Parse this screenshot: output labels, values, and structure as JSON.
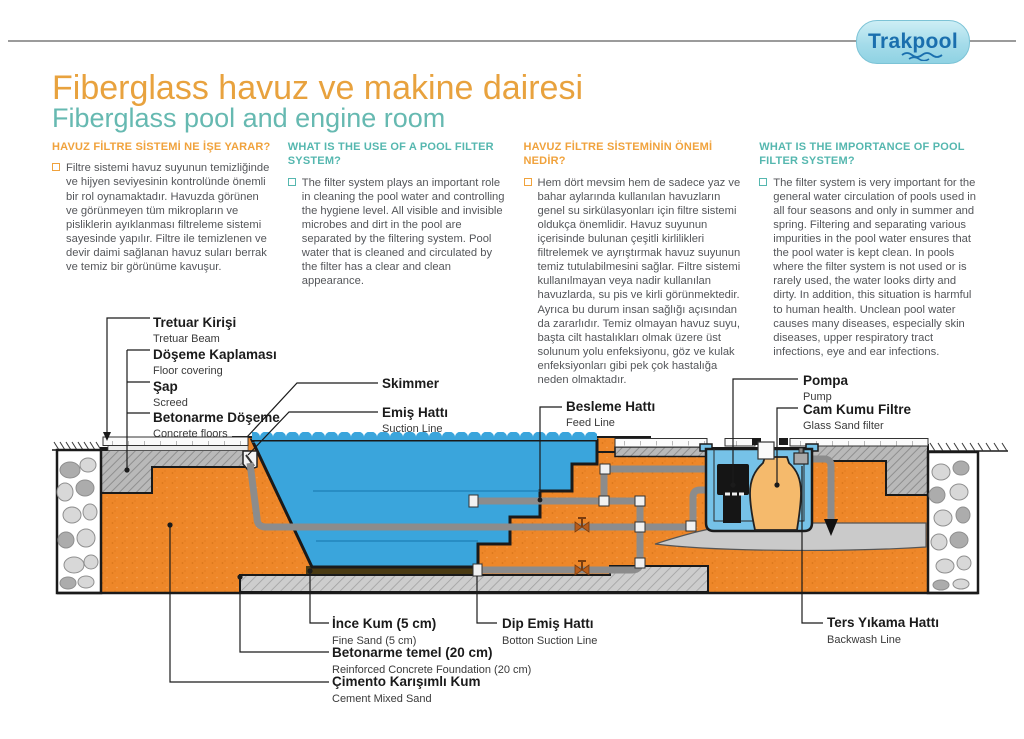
{
  "logo": {
    "text": "Trakpool"
  },
  "header": {
    "title_tr": "Fiberglass havuz ve makine dairesi",
    "title_en": "Fiberglass pool and engine room"
  },
  "columns": [
    {
      "accent": "orange",
      "heading": "HAVUZ FİLTRE SİSTEMİ NE İŞE YARAR?",
      "body": "Filtre sistemi havuz suyunun temizliğinde ve hijyen seviyesinin kontrolünde önemli bir rol oynamaktadır. Havuzda görünen ve görünmeyen tüm mikropların ve pisliklerin ayıklanması filtreleme sistemi sayesinde yapılır. Filtre ile temizlenen ve devir daimi sağlanan havuz suları berrak ve temiz bir görünüme kavuşur."
    },
    {
      "accent": "teal",
      "heading": "WHAT IS THE USE OF A POOL FILTER SYSTEM?",
      "body": "The filter system plays an important role in cleaning the pool water and controlling the hygiene level. All visible and invisible microbes and dirt in the pool are separated by the filtering system. Pool water that is cleaned and circulated by the filter has a clear and clean appearance."
    },
    {
      "accent": "orange",
      "heading": "HAVUZ FİLTRE SİSTEMİNİN ÖNEMİ NEDİR?",
      "body": "Hem dört mevsim hem de sadece yaz ve bahar aylarında kullanılan havuzların genel su sirkülasyonları için filtre sistemi oldukça önemlidir. Havuz suyunun içerisinde bulunan çeşitli kirlilikleri filtrelemek ve ayrıştırmak havuz suyunun temiz tutulabilmesini sağlar. Filtre sistemi kullanılmayan veya nadir kullanılan havuzlarda, su pis ve kirli görünmektedir. Ayrıca bu durum insan sağlığı açısından da zararlıdır. Temiz olmayan havuz suyu, başta cilt hastalıkları olmak üzere üst solunum yolu enfeksiyonu, göz ve kulak enfeksiyonları gibi pek çok hastalığa neden olmaktadır."
    },
    {
      "accent": "teal",
      "heading": "WHAT IS THE IMPORTANCE OF POOL FILTER SYSTEM?",
      "body": "The filter system is very important for the general water circulation of pools used in all four seasons and only in summer and spring. Filtering and separating various impurities in the pool water ensures that the pool water is kept clean. In pools where the filter system is not used or is rarely used, the water looks dirty and dirty. In addition, this situation is harmful to human health. Unclean pool water causes many diseases, especially skin diseases, upper respiratory tract infections, eye and ear infections."
    }
  ],
  "diagram": {
    "labels": {
      "tretuar": {
        "tr": "Tretuar Kirişi",
        "en": "Tretuar Beam"
      },
      "doseme": {
        "tr": "Döşeme Kaplaması",
        "en": "Floor covering"
      },
      "sap": {
        "tr": "Şap",
        "en": "Screed"
      },
      "betonarme_doseme": {
        "tr": "Betonarme Döşeme",
        "en": "Concrete floors"
      },
      "skimmer": {
        "tr": "Skimmer",
        "en": ""
      },
      "emis": {
        "tr": "Emiş Hattı",
        "en": "Suction Line"
      },
      "besleme": {
        "tr": "Besleme Hattı",
        "en": "Feed Line"
      },
      "pompa": {
        "tr": "Pompa",
        "en": "Pump"
      },
      "cam_kumu": {
        "tr": "Cam Kumu Filtre",
        "en": "Glass Sand filter"
      },
      "ince_kum": {
        "tr": "İnce Kum (5 cm)",
        "en": "Fine Sand (5 cm)"
      },
      "dip_emis": {
        "tr": "Dip Emiş Hattı",
        "en": "Botton Suction Line"
      },
      "betonarme_temel": {
        "tr": "Betonarme temel (20 cm)",
        "en": "Reinforced Concrete Foundation (20 cm)"
      },
      "cimento": {
        "tr": "Çimento Karışımlı Kum",
        "en": "Cement Mixed Sand"
      },
      "ters_yikama": {
        "tr": "Ters Yıkama Hattı",
        "en": "Backwash Line"
      }
    }
  },
  "colors": {
    "accent_orange": "#f0a23c",
    "accent_teal": "#55b7af",
    "title_orange": "#e8a23e",
    "subtitle_teal": "#66b9b1",
    "water_blue": "#3aa5dc",
    "pit_blue": "#76c2e8",
    "sand_orange": "#ee8729",
    "filter_tan": "#f5ba6c",
    "concrete_gray": "#b7b7b7",
    "logo_blue": "#1a6fae"
  }
}
